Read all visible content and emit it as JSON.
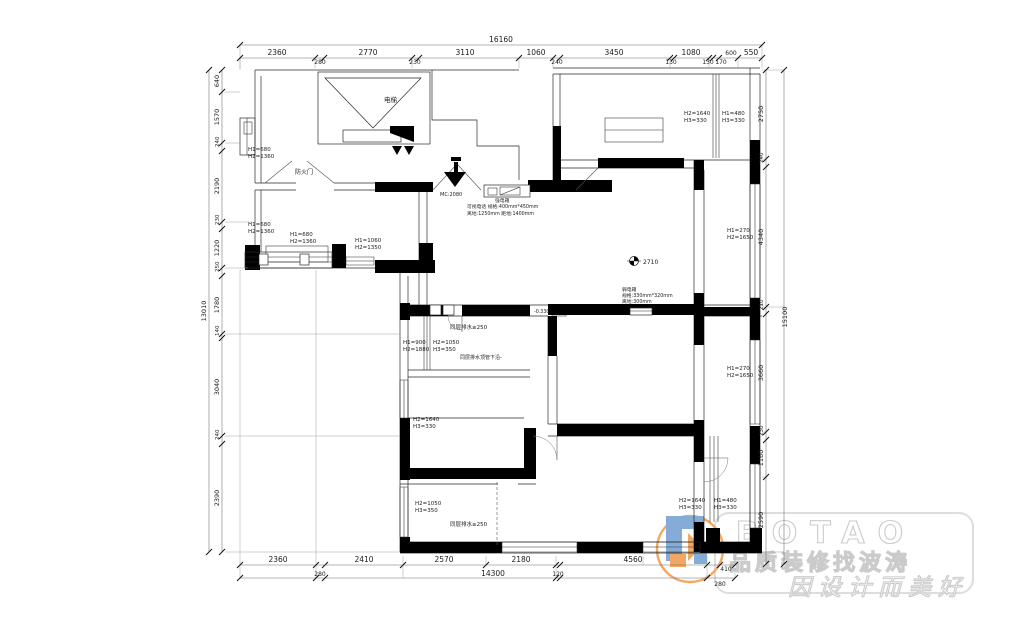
{
  "drawing": {
    "dims_top": {
      "total": "16160",
      "segs": [
        "2360",
        "280",
        "2770",
        "230",
        "3110",
        "1060",
        "240",
        "3450",
        "130",
        "1080",
        "130",
        "170",
        "600",
        "550"
      ]
    },
    "dims_bottom": {
      "row1": [
        "2360",
        "2410",
        "2570",
        "2180",
        "4560",
        "410"
      ],
      "row2": [
        "280",
        "14300",
        "120",
        "280"
      ]
    },
    "dims_left": {
      "total": "13010",
      "segs": [
        "640",
        "1570",
        "240",
        "2190",
        "230",
        "1220",
        "250",
        "1780",
        "140",
        "3040",
        "240",
        "2390"
      ]
    },
    "dims_right": {
      "total": "15100",
      "segs": [
        "2750",
        "240",
        "4340",
        "210",
        "3660",
        "230",
        "1160",
        "2590"
      ]
    },
    "rooms": {
      "elevator": "电梯"
    },
    "doors": {
      "fire_door": "防火门",
      "entry": "MC:2080"
    },
    "notes": {
      "intercom_title": "强电箱",
      "intercom_line1": "可视电话  规格:400mm*450mm",
      "intercom_line2": "离地:1250mm 距地:1400mm",
      "weakbox_title": "弱电箱",
      "weakbox_line1": "规格:330mm*320mm",
      "weakbox_line2": "离地:300mm",
      "ceiling": "2710",
      "level": "-0.330",
      "drain_top": "同层排水≥250",
      "drain_note": "同层排水顶管下沿-",
      "drain_bottom": "同层排水≥250"
    },
    "window_tags": {
      "t1": {
        "a": "H1=680",
        "b": "H2=1360"
      },
      "t2": {
        "a": "H1=680",
        "b": "H2=1360"
      },
      "t3": {
        "a": "H1=680",
        "b": "H2=1360"
      },
      "t4": {
        "a": "H1=1060",
        "b": "H2=1350"
      },
      "t5": {
        "a": "H2=1640",
        "b": "H3=330"
      },
      "t6": {
        "a": "H1=480",
        "b": "H3=330"
      },
      "t7": {
        "a": "H1=270",
        "b": "H2=1650"
      },
      "t8": {
        "a": "H1=270",
        "b": "H2=1650"
      },
      "t9": {
        "a": "H1=900",
        "b": "H2=1880"
      },
      "t10": {
        "a": "H2=1050",
        "b": "H3=350"
      },
      "t11": {
        "a": "H2=1640",
        "b": "H3=330"
      },
      "t12": {
        "a": "H2=1050",
        "b": "H3=350"
      },
      "t13": {
        "a": "H2=1640",
        "b": "H3=330"
      },
      "t14": {
        "a": "H1=480",
        "b": "H3=330"
      }
    }
  },
  "watermark": {
    "brand": "BOTAO",
    "slogan1": "品质装修找波涛",
    "slogan2": "因设计而美好",
    "circle_color": "#F2A45A",
    "blue": "#7FA8D8",
    "orange": "#F2A45A"
  }
}
